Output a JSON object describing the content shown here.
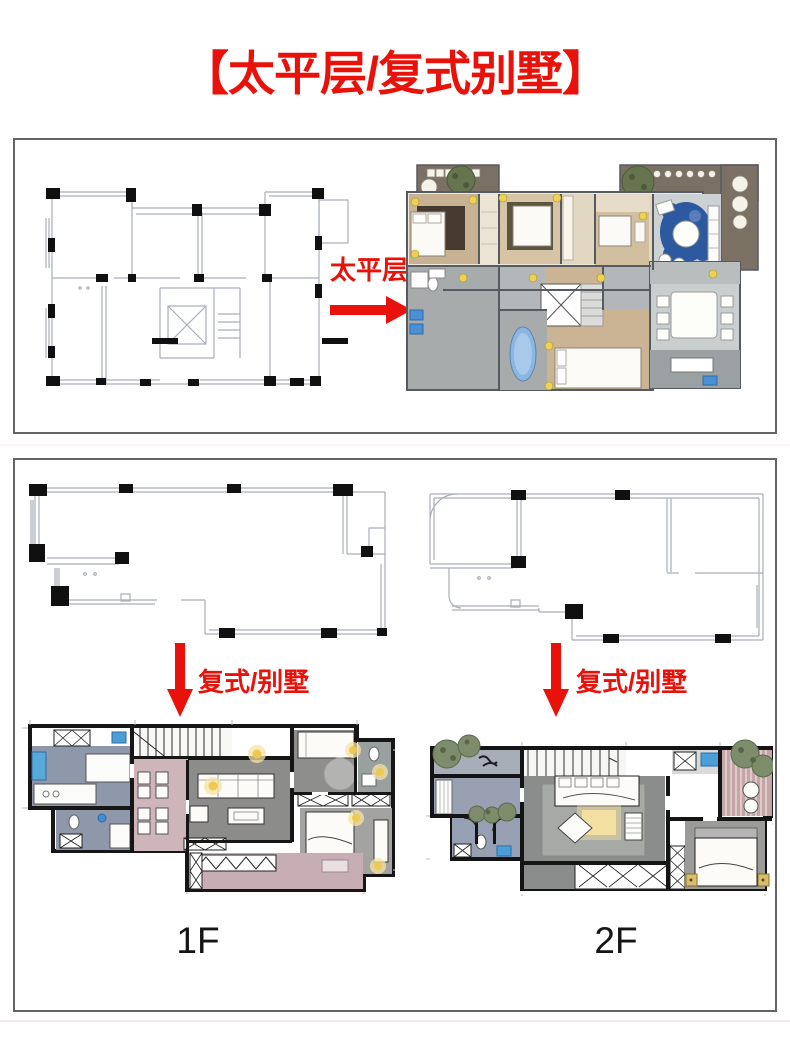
{
  "title": "【太平层/复式别墅】",
  "flat_panel": {
    "arrow_label": "太平层"
  },
  "duplex_panel": {
    "left": {
      "arrow_label": "复式/别墅",
      "floor_label": "1F"
    },
    "right": {
      "arrow_label": "复式/别墅",
      "floor_label": "2F"
    }
  },
  "colors": {
    "accent_red": "#e8120b",
    "panel_border": "#646464",
    "line_plan_gray": "#a9aeb9",
    "wall_black": "#141414"
  },
  "icons": {
    "flat": "right-arrow-icon",
    "duplex": "down-arrow-icon"
  }
}
